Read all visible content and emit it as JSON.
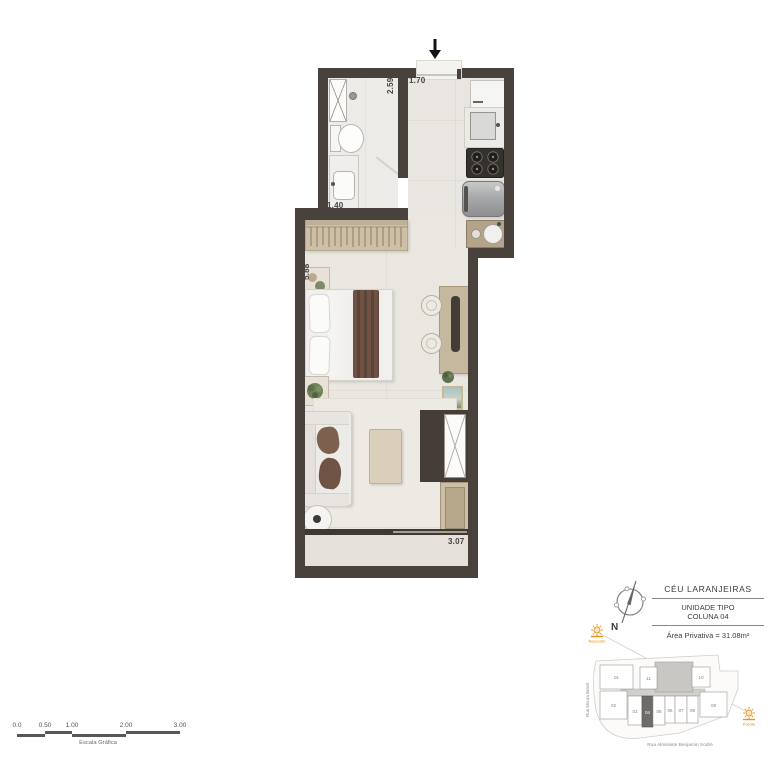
{
  "plan": {
    "dimensions": {
      "bath_length": "2.59",
      "entry_width": "1.70",
      "bath_width": "1.40",
      "living_length": "5.88",
      "balcony_depth": "0.60",
      "balcony_width": "3.07"
    }
  },
  "legend": {
    "project": "CÉU LARANJEIRAS",
    "unit_line1": "UNIDADE TIPO",
    "unit_line2": "COLUNA 04",
    "area": "Área Privativa = 31.08m²",
    "north": "N"
  },
  "site_plan": {
    "street_left": "Rua Moura Brasil",
    "street_bottom": "Rua Almirante Benjamin Sodré",
    "sun_rise": "Nascente",
    "sun_set": "Poente",
    "highlighted_unit": "04",
    "units": [
      "01",
      "11",
      "10",
      "02",
      "03",
      "04",
      "05",
      "06",
      "07",
      "09",
      "08"
    ]
  },
  "scale_bar": {
    "labels": [
      "0.0",
      "0.50",
      "1.00",
      "2.00",
      "3.00"
    ],
    "caption": "Escala Gráfica"
  },
  "colors": {
    "wall": "#49413b",
    "floor": "#eae6e0",
    "wood": "#cdc0a6",
    "sun_accent": "#e8921e",
    "highlight_unit": "#6e6c69"
  }
}
